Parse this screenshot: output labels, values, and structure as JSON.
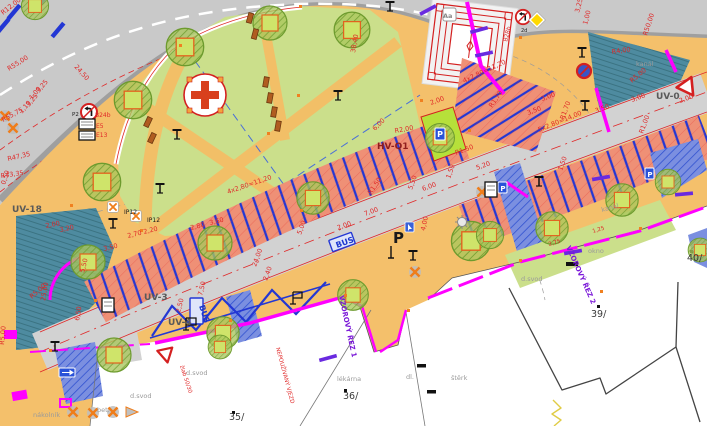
{
  "colors": {
    "road_asphalt": "#c9c9c9",
    "road_curb": "#9f9f9f",
    "sidewalk_plaza": "#f4c06b",
    "lawn_park": "#cbdf8b",
    "parking_fill": "#ef9076",
    "stall_divider_blue": "#2337d4",
    "water_channel_teal": "#4e8ba0",
    "property_boundary_magenta": "#ff00ff",
    "dimension_red": "#e02828",
    "section_purple": "#7a18d8",
    "tree_green": "#a9c65c",
    "crossing_blue": "#7b8fe0",
    "bench_brown": "#b05c20",
    "note_gray": "#9a9a9a",
    "area_label_gray": "#5a5a5a",
    "hv_label_dark_red": "#8f1d1d"
  },
  "icons": [
    "no-left-turn-sign",
    "no-stopping-sign",
    "give-way-sign",
    "priority-road-sign",
    "one-way-sign",
    "parking-sign",
    "ip12-sign",
    "street-lamp",
    "tree",
    "felled-tree-marker",
    "bench",
    "manhole",
    "bus-stop-marking",
    "pedestrian-crossing",
    "monument-plan",
    "playground-cross",
    "info-box"
  ],
  "annotations": {
    "area_labels": [
      {
        "t": "UV-18",
        "x": 12,
        "y": 212,
        "c": "#5a5a5a",
        "s": 9,
        "b": 1
      },
      {
        "t": "UV-3",
        "x": 144,
        "y": 300,
        "c": "#5a5a5a",
        "s": 9,
        "b": 1
      },
      {
        "t": "UV-4",
        "x": 168,
        "y": 325,
        "c": "#5a5a5a",
        "s": 9,
        "b": 1
      },
      {
        "t": "UV-0",
        "x": 656,
        "y": 99,
        "c": "#5a5a5a",
        "s": 9,
        "b": 1
      },
      {
        "t": "HV-Q1",
        "x": 377,
        "y": 149,
        "c": "#8f1d1d",
        "s": 9,
        "b": 1
      }
    ],
    "plot_numbers": [
      {
        "t": "35/",
        "x": 229,
        "y": 420,
        "c": "#3a3a3a",
        "s": 9.5
      },
      {
        "t": "36/",
        "x": 343,
        "y": 399,
        "c": "#3a3a3a",
        "s": 9.5
      },
      {
        "t": "39/",
        "x": 591,
        "y": 317,
        "c": "#3a3a3a",
        "s": 9.5
      },
      {
        "t": "40/",
        "x": 687,
        "y": 261,
        "c": "#3a3a3a",
        "s": 9.5
      }
    ],
    "surface_notes": [
      {
        "t": "kanál",
        "x": 636,
        "y": 66,
        "c": "#9a9a9a",
        "s": 6.5
      },
      {
        "t": "kanál",
        "x": 602,
        "y": 212,
        "r": -15,
        "c": "#9a9a9a",
        "s": 6.5
      },
      {
        "t": "okno",
        "x": 588,
        "y": 253,
        "c": "#9a9a9a",
        "s": 6.5
      },
      {
        "t": "d.svod",
        "x": 186,
        "y": 375,
        "c": "#9a9a9a",
        "s": 6.5
      },
      {
        "t": "d.svod",
        "x": 130,
        "y": 398,
        "c": "#9a9a9a",
        "s": 6.5
      },
      {
        "t": "d.svod",
        "x": 521,
        "y": 281,
        "c": "#9a9a9a",
        "s": 6.5
      },
      {
        "t": "štěrk",
        "x": 451,
        "y": 380,
        "c": "#9a9a9a",
        "s": 6.5
      },
      {
        "t": "dl.",
        "x": 406,
        "y": 379,
        "c": "#9a9a9a",
        "s": 6.5
      },
      {
        "t": "lékárna",
        "x": 337,
        "y": 381,
        "c": "#9a9a9a",
        "s": 6.5
      },
      {
        "t": "nákolník",
        "x": 33,
        "y": 417,
        "c": "#9a9a9a",
        "s": 6.5
      },
      {
        "t": "bet.",
        "x": 97,
        "y": 412,
        "c": "#9a9a9a",
        "s": 6.5
      }
    ],
    "red_notes": [
      {
        "t": "NEPOUŽÍVANÝ VJEZD",
        "x": 276,
        "y": 348,
        "r": 75,
        "c": "#e02828",
        "s": 5.5
      },
      {
        "t": "žlab 50/30",
        "x": 180,
        "y": 366,
        "r": 72,
        "c": "#e02828",
        "s": 5.5
      }
    ],
    "section_labels": [
      {
        "t": "VZOROVÝ ŘEZ 1",
        "x": 339,
        "y": 296,
        "r": 78,
        "c": "#7a18d8",
        "s": 7,
        "b": 1
      },
      {
        "t": "VZOROVÝ ŘEZ 2",
        "x": 566,
        "y": 247,
        "r": 66,
        "c": "#7a18d8",
        "s": 7,
        "b": 1
      }
    ],
    "traffic_sign_labels": [
      {
        "t": "B24b",
        "x": 95,
        "y": 117,
        "c": "#e02828",
        "s": 6
      },
      {
        "t": "E5",
        "x": 96,
        "y": 128,
        "c": "#e02828",
        "s": 6
      },
      {
        "t": "E13",
        "x": 96,
        "y": 137,
        "c": "#e02828",
        "s": 6
      },
      {
        "t": "P2",
        "x": 72,
        "y": 116,
        "c": "#1a1a1a",
        "s": 5.5
      },
      {
        "t": "IP12",
        "x": 124,
        "y": 214,
        "c": "#1a1a1a",
        "s": 6
      },
      {
        "t": "IP12",
        "x": 147,
        "y": 222,
        "c": "#1a1a1a",
        "s": 6
      },
      {
        "t": "B28b",
        "x": 507,
        "y": 42,
        "r": -75,
        "c": "#e02828",
        "s": 6
      },
      {
        "t": "2d",
        "x": 521,
        "y": 32,
        "c": "#1a1a1a",
        "s": 5
      },
      {
        "t": "Aa",
        "x": 443,
        "y": 18,
        "c": "#888888",
        "s": 6.5,
        "b": 1
      },
      {
        "t": "P",
        "x": 440,
        "y": 137,
        "c": "#ffffff",
        "s": 8,
        "b": 1,
        "a": "m"
      },
      {
        "t": "P",
        "x": 650,
        "y": 177,
        "c": "#ffffff",
        "s": 7,
        "b": 1,
        "a": "m"
      },
      {
        "t": "P",
        "x": 503,
        "y": 191,
        "c": "#ffffff",
        "s": 7,
        "b": 1,
        "a": "m"
      }
    ],
    "road_markings": [
      {
        "t": "BUS",
        "x": 337,
        "y": 248,
        "r": -20,
        "c": "#1a35cf",
        "s": 8,
        "b": 1
      },
      {
        "t": "BUS",
        "x": 199,
        "y": 306,
        "r": 72,
        "c": "#1a35cf",
        "s": 8,
        "b": 1
      },
      {
        "t": "P",
        "x": 393,
        "y": 243,
        "c": "#1a1a1a",
        "s": 15,
        "b": 1
      }
    ],
    "dimensions": [
      {
        "t": "R12,00",
        "x": 3,
        "y": 15,
        "r": -38
      },
      {
        "t": "R55,00",
        "x": 9,
        "y": 71,
        "r": -32
      },
      {
        "t": "3,25",
        "x": 39,
        "y": 93,
        "r": -50
      },
      {
        "t": "1,00",
        "x": 32,
        "y": 100,
        "r": -50
      },
      {
        "t": "3,25",
        "x": 29,
        "y": 107,
        "r": -50
      },
      {
        "t": "1,10",
        "x": 22,
        "y": 114,
        "r": -50
      },
      {
        "t": "R55,75",
        "x": 3,
        "y": 122,
        "r": -28
      },
      {
        "t": "R47,35",
        "x": 8,
        "y": 161,
        "r": -13
      },
      {
        "t": "0,50",
        "x": 5,
        "y": 185,
        "r": -72
      },
      {
        "t": "R43,35",
        "x": 1,
        "y": 178,
        "r": -8
      },
      {
        "t": "24,50",
        "x": 74,
        "y": 67,
        "r": 48
      },
      {
        "t": "38,40",
        "x": 355,
        "y": 53,
        "r": -80
      },
      {
        "t": "2,00",
        "x": 431,
        "y": 105,
        "r": -20
      },
      {
        "t": "R2,00",
        "x": 395,
        "y": 133,
        "r": -10
      },
      {
        "t": "6,00",
        "x": 375,
        "y": 131,
        "r": -45
      },
      {
        "t": "3,25",
        "x": 579,
        "y": 13,
        "r": -75
      },
      {
        "t": "1,00",
        "x": 587,
        "y": 25,
        "r": -75
      },
      {
        "t": "R50,00",
        "x": 647,
        "y": 36,
        "r": -72
      },
      {
        "t": "R4,00",
        "x": 612,
        "y": 54,
        "r": -8
      },
      {
        "t": "R5,00",
        "x": 632,
        "y": 83,
        "r": -40
      },
      {
        "t": "R1,00",
        "x": 643,
        "y": 134,
        "r": -70
      },
      {
        "t": "2,00",
        "x": 680,
        "y": 103,
        "r": -20
      },
      {
        "t": "3,00",
        "x": 632,
        "y": 102,
        "r": -20
      },
      {
        "t": "3,50",
        "x": 596,
        "y": 113,
        "r": -20
      },
      {
        "t": "R1,70",
        "x": 564,
        "y": 120,
        "r": -70
      },
      {
        "t": "5x2,80=14,00",
        "x": 539,
        "y": 132,
        "r": -22
      },
      {
        "t": "3,00",
        "x": 542,
        "y": 101,
        "r": -20
      },
      {
        "t": "3,50",
        "x": 528,
        "y": 115,
        "r": -20
      },
      {
        "t": "R1,70",
        "x": 492,
        "y": 108,
        "r": -55
      },
      {
        "t": "4x2,80=11,20",
        "x": 464,
        "y": 83,
        "r": -25
      },
      {
        "t": "R1,50",
        "x": 456,
        "y": 155,
        "r": -20
      },
      {
        "t": "5,20",
        "x": 477,
        "y": 170,
        "r": -20
      },
      {
        "t": "6,00",
        "x": 423,
        "y": 191,
        "r": -20
      },
      {
        "t": "5,50",
        "x": 412,
        "y": 190,
        "r": -70
      },
      {
        "t": "1,50",
        "x": 450,
        "y": 179,
        "r": -70
      },
      {
        "t": "1,50",
        "x": 562,
        "y": 171,
        "r": -70
      },
      {
        "t": "R1,50",
        "x": 371,
        "y": 195,
        "r": -55
      },
      {
        "t": "7,00",
        "x": 365,
        "y": 216,
        "r": -20
      },
      {
        "t": "2,00",
        "x": 338,
        "y": 230,
        "r": -20
      },
      {
        "t": "5,00",
        "x": 301,
        "y": 235,
        "r": -70
      },
      {
        "t": "4,00",
        "x": 425,
        "y": 231,
        "r": -78
      },
      {
        "t": "24,00",
        "x": 256,
        "y": 267,
        "r": -70
      },
      {
        "t": "2,40",
        "x": 267,
        "y": 281,
        "r": -70
      },
      {
        "t": "7,50",
        "x": 202,
        "y": 296,
        "r": -75
      },
      {
        "t": "2,50",
        "x": 180,
        "y": 313,
        "r": -75
      },
      {
        "t": "4x2,80=11,20",
        "x": 228,
        "y": 194,
        "r": -19
      },
      {
        "t": "2,00",
        "x": 46,
        "y": 228,
        "r": -12
      },
      {
        "t": "3,20",
        "x": 60,
        "y": 232,
        "r": -12
      },
      {
        "t": "3,50",
        "x": 104,
        "y": 251,
        "r": -14
      },
      {
        "t": "2,70",
        "x": 128,
        "y": 238,
        "r": -14
      },
      {
        "t": "2,20",
        "x": 144,
        "y": 234,
        "r": -14
      },
      {
        "t": "2,80",
        "x": 191,
        "y": 230,
        "r": -14
      },
      {
        "t": "3,60",
        "x": 210,
        "y": 225,
        "r": -14
      },
      {
        "t": "5,50",
        "x": 84,
        "y": 273,
        "r": -75
      },
      {
        "t": "6,50",
        "x": 79,
        "y": 321,
        "r": -80
      },
      {
        "t": "25,00",
        "x": 45,
        "y": 301,
        "r": -80
      },
      {
        "t": "R5,00",
        "x": 4,
        "y": 345,
        "r": -85
      },
      {
        "t": "R5,00",
        "x": 32,
        "y": 299,
        "r": -42
      },
      {
        "t": "2,75",
        "x": 549,
        "y": 246,
        "r": -17,
        "s": 5.5
      },
      {
        "t": "1,25",
        "x": 593,
        "y": 233,
        "r": -17,
        "s": 5.5
      }
    ]
  }
}
